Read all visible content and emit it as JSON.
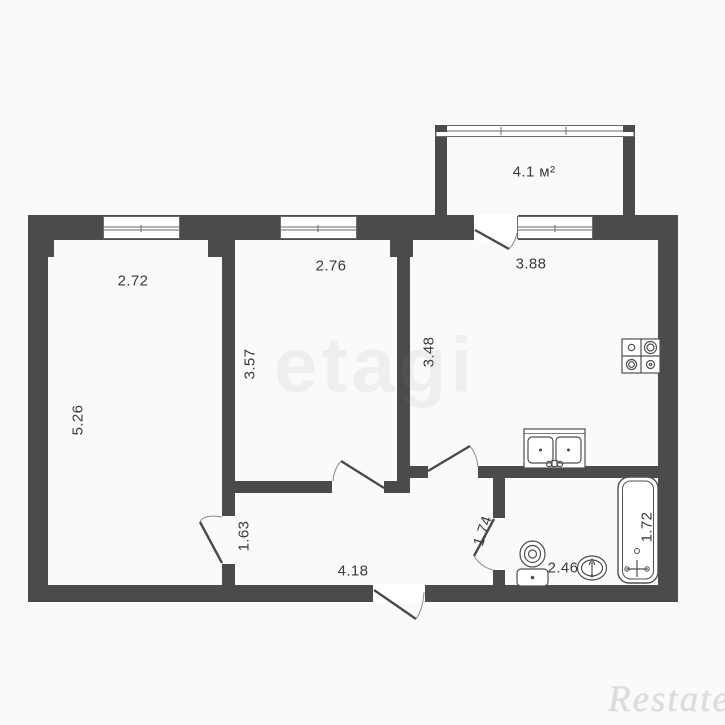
{
  "plan_title": "2-room apartment floor plan",
  "colors": {
    "background": "#fbfaf8",
    "paper": "#ffffff",
    "wall": "#4d4b49",
    "line": "#4f4f4f",
    "label": "#3a3a3a",
    "watermark": "#dcdcdc"
  },
  "labels": {
    "balcony_area": "4.1 м²",
    "room_left_width": "2.72",
    "room_left_height": "5.26",
    "room_middle_width": "2.76",
    "room_middle_height": "3.57",
    "kitchen_width": "3.88",
    "kitchen_height": "3.48",
    "hall_left": "1.63",
    "hall_width": "4.18",
    "hall_right": "1.74",
    "bath_width": "2.46",
    "tub_length": "1.72"
  },
  "watermarks": {
    "brand": "Restate",
    "center": "etagi"
  },
  "icons": {
    "stove-icon": "svg-shape",
    "kitchen-sink-icon": "svg-shape",
    "toilet-icon": "svg-shape",
    "washbasin-icon": "svg-shape",
    "bathtub-icon": "svg-shape",
    "window-icon": "svg-shape",
    "balcony-glazing-icon": "svg-shape",
    "door-swing-icon": "svg-shape"
  }
}
